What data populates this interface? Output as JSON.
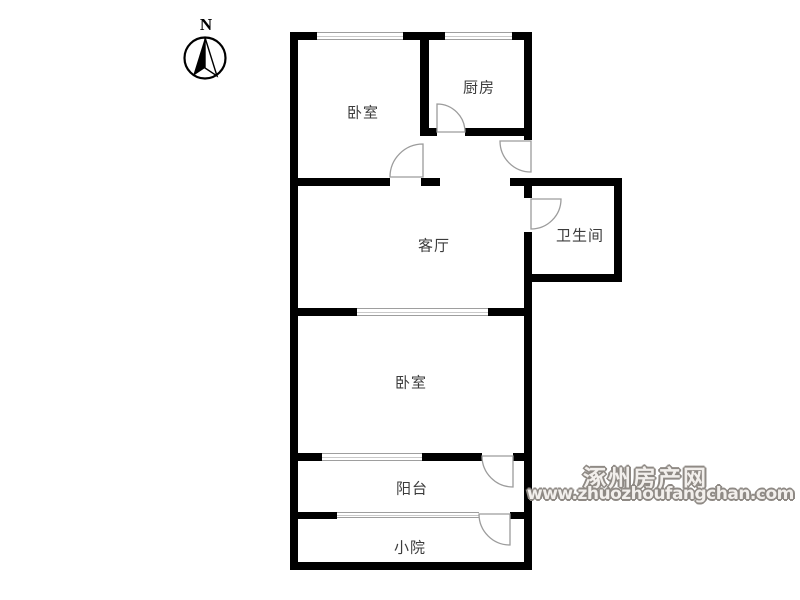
{
  "compass": {
    "label": "N"
  },
  "plan": {
    "rooms": [
      {
        "name": "bedroom-north",
        "label": "卧室"
      },
      {
        "name": "kitchen",
        "label": "厨房"
      },
      {
        "name": "living-room",
        "label": "客厅"
      },
      {
        "name": "bathroom",
        "label": "卫生间"
      },
      {
        "name": "bedroom-south",
        "label": "卧室"
      },
      {
        "name": "balcony",
        "label": "阳台"
      },
      {
        "name": "courtyard",
        "label": "小院"
      }
    ]
  },
  "watermark": {
    "site_name": "涿州房产网",
    "site_url": "www.zhuozhoufangchan.com"
  },
  "colors": {
    "wall": "#000000",
    "door_arc": "#9c9c9c",
    "window_frame": "#9e9e9e",
    "label_text": "#3c3c3c",
    "watermark": "#8f8a85"
  }
}
